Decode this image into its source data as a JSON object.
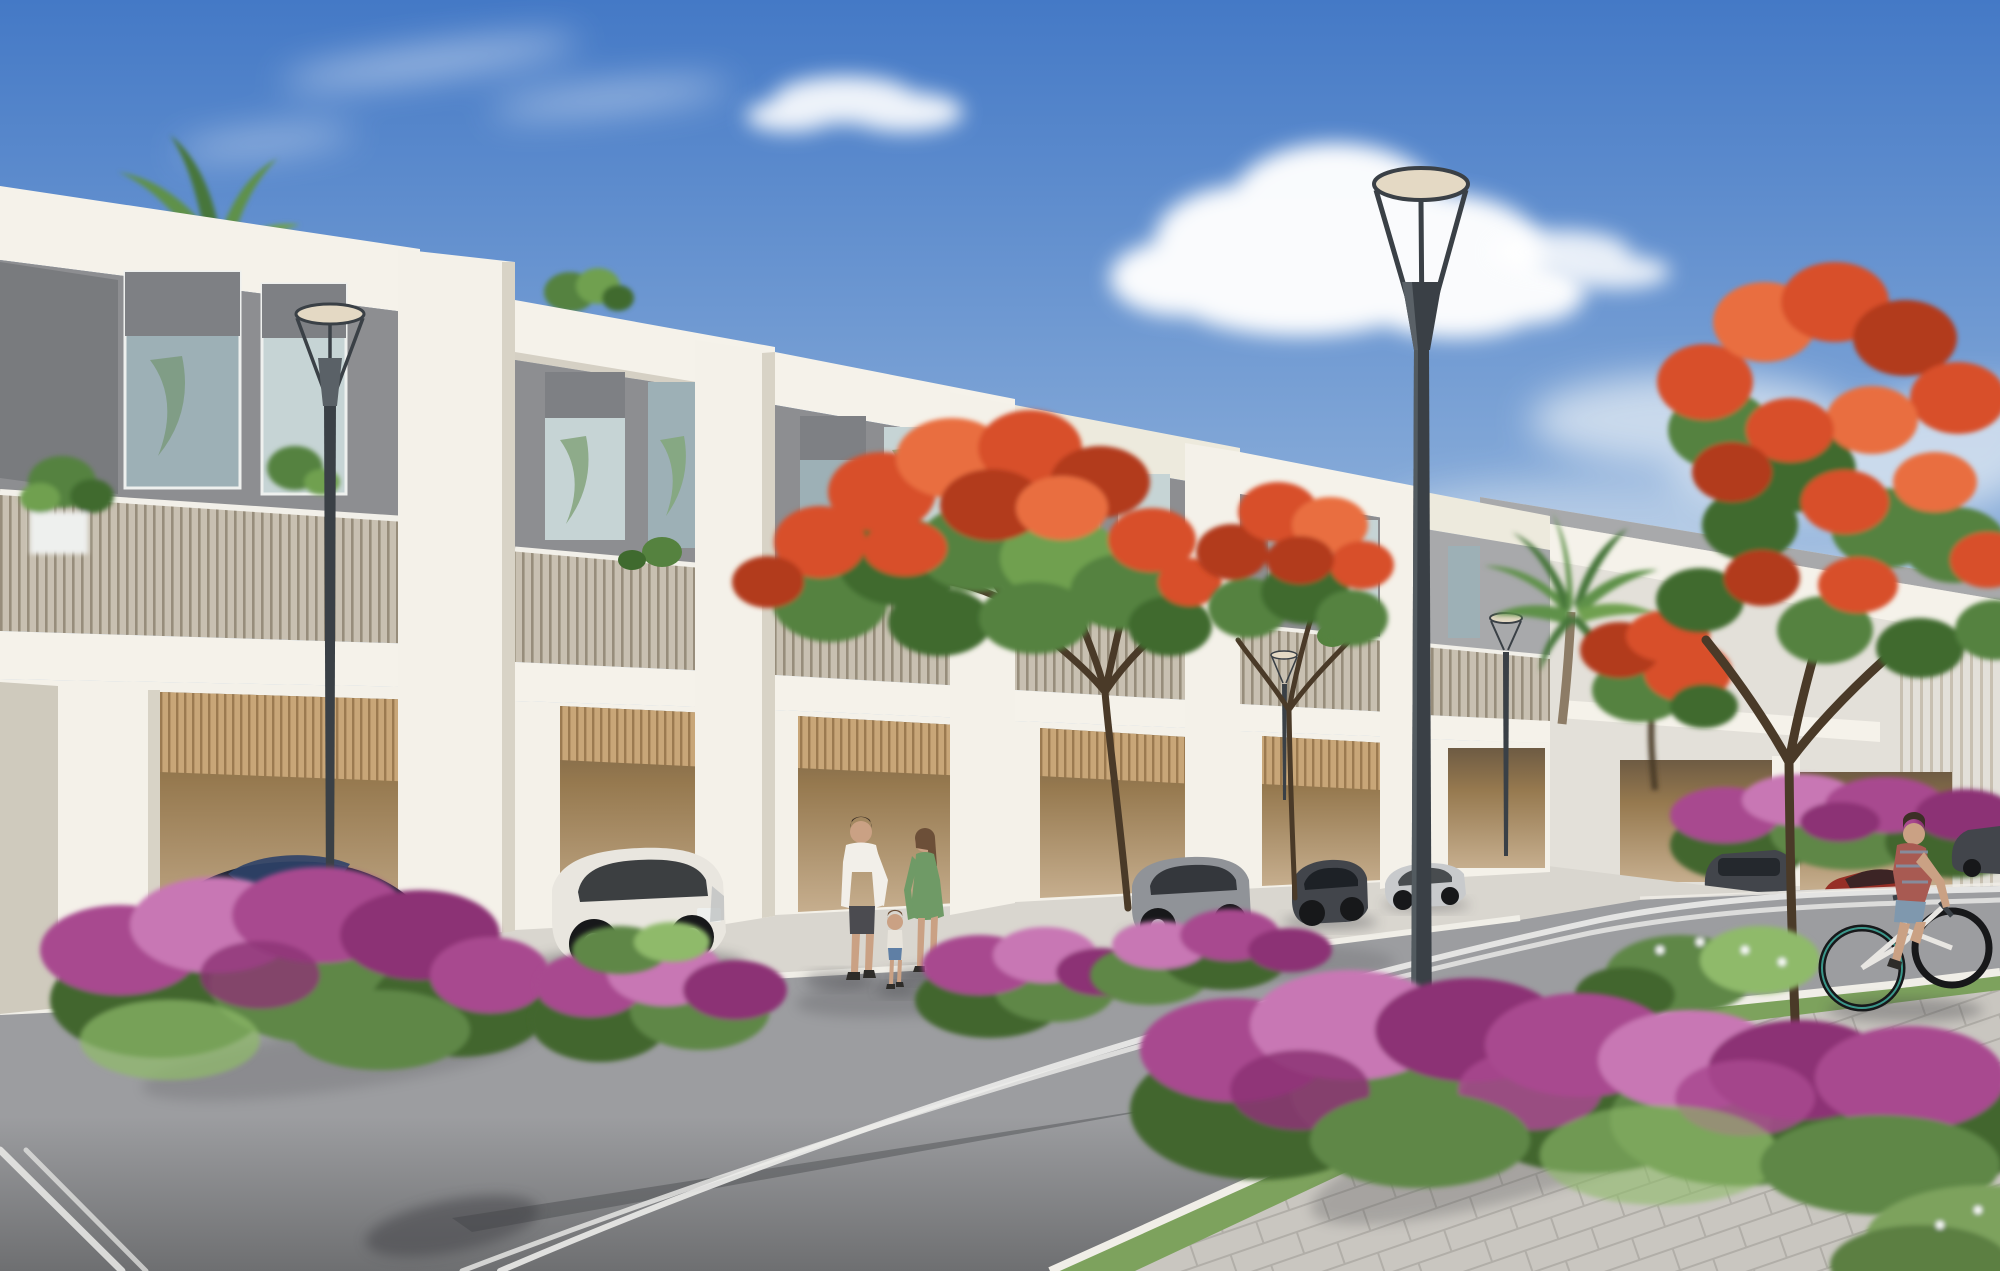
{
  "scene": {
    "title": "Townhouse community street rendering",
    "description": "Photorealistic daytime architectural rendering: a receding row of modern two-storey white-and-grey townhouses with slatted balcony railings and open carports holding parked cars, along a curving asphalt street with double white lane lines, paver sidewalk, grass verges and bougainvillea flower beds; red-flowering flame trees and a date palm line the street; saucer-top street lamps; a family of three walks on the pavement and a woman cycles past on the right under a blue sky with cumulus clouds.",
    "time_of_day": "day",
    "people": [
      "man in white shirt walking",
      "woman in green dress",
      "toddler between parents",
      "female cyclist in plaid shirt"
    ],
    "vehicles": [
      "dark sports car",
      "white SUV",
      "grey SUV",
      "dark SUV",
      "silver sedan",
      "red car",
      "distant dark car"
    ],
    "vegetation": [
      "flame trees with red blossoms",
      "date palm",
      "rooftop palm",
      "bougainvillea beds",
      "balcony plants",
      "grass verge",
      "green shrubs"
    ],
    "street_furniture": [
      "saucer-top street lamp large",
      "saucer-top street lamp small x3"
    ]
  },
  "colors": {
    "sky_top": "#4479c6",
    "sky_mid": "#93b4dc",
    "sky_horizon": "#d8e1ea",
    "cloud_white": "#ffffff",
    "cloud_shade": "#dde7f2",
    "facade_white": "#f5f2ea",
    "facade_cream": "#edeadd",
    "facade_shadow": "#cfcabd",
    "fascia_underside": "#b5ad9e",
    "wall_gray": "#8d8e91",
    "wall_gray_dark": "#797b7e",
    "wall_gray_light": "#a8a9ab",
    "glass": "#9db0b6",
    "glass_light": "#c6d4d5",
    "shade_gray": "#7e8084",
    "frame_white": "#eef0ee",
    "railing_base": "#c8c0b1",
    "railing_slat": "#978d7b",
    "railing_cap": "#f2f0e9",
    "carport_beige": "#c6ae8e",
    "carport_dark": "#96794f",
    "carport_shadow": "#6e5b43",
    "wood_slat": "#c8a678",
    "wood_slat_dark": "#9b7a50",
    "pier_white": "#f4f1e9",
    "pier_shadow": "#d8d3c6",
    "apron": "#d9d6cf",
    "apron_far": "#e3e0d9",
    "asphalt_far": "#9c9da0",
    "asphalt_near": "#6e6f71",
    "road_line": "#ececea",
    "curb": "#f0eee7",
    "paver": "#c9c6c0",
    "paver_line": "#b1aea8",
    "grass": "#7da25d",
    "grass_dark": "#5c7f42",
    "shrub": "#5e8747",
    "shrub_dark": "#42662f",
    "shrub_light": "#8fba6a",
    "bougain": "#a8498f",
    "bougain_dark": "#8c3374",
    "bougain_light": "#c877b4",
    "flame": "#d8502a",
    "flame_dark": "#b23a1a",
    "flame_light": "#e96e40",
    "leaf": "#55823f",
    "leaf_dark": "#3f6a2e",
    "leaf_light": "#6fa04f",
    "trunk": "#55432f",
    "branch": "#4a3a28",
    "palm_green": "#5f914a",
    "palm_dark": "#47763a",
    "palm_trunk": "#8d7c66",
    "lamp_dark": "#3a4046",
    "lamp_mid": "#5a6167",
    "lamp_disc": "#e4d9c4",
    "skin": "#caa184",
    "hair_dark": "#3c2f26",
    "hair_brown": "#6c4f38",
    "man_shirt": "#f2efe9",
    "man_shorts": "#4b4b50",
    "shoe_dark": "#2e2c29",
    "woman_dress": "#6f9a66",
    "child_top": "#e8e4dc",
    "child_shorts": "#5f7fa5",
    "cyclist_shirt": "#a85a52",
    "cyclist_shorts": "#7f98ae",
    "bike_teal": "#43b7a6",
    "bike_frame": "#e8e6e2",
    "car_sport": "#232838",
    "car_sport_blue": "#2e4168",
    "car_white": "#e9e6df",
    "car_gray": "#909398",
    "car_dark": "#42454b",
    "car_silver": "#c8cacc",
    "car_red": "#962f26",
    "window_dark": "#1d2126",
    "wheel_dark": "#17181a",
    "rim_silver": "#b9bcbe",
    "shadow": "#3f4144"
  }
}
